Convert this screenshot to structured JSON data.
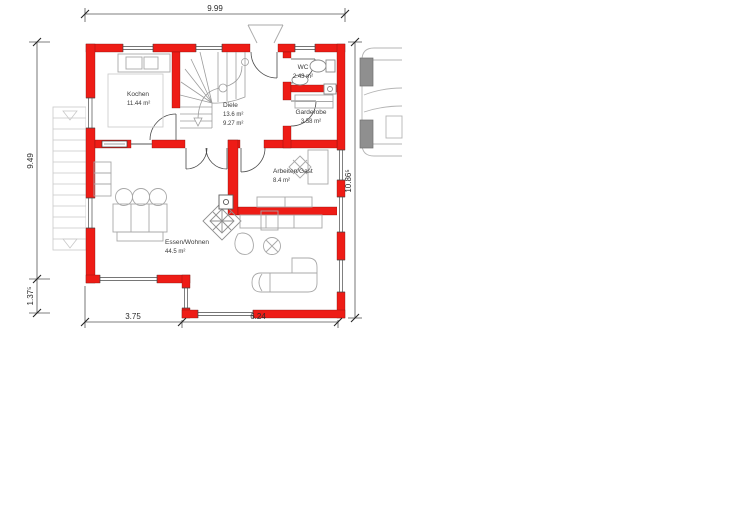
{
  "floorplan": {
    "rooms": {
      "kochen": {
        "name": "Kochen",
        "area": "11.44 m²"
      },
      "diele": {
        "name": "Diele",
        "area1": "13.6 m²",
        "area2": "9.27 m²"
      },
      "wc": {
        "name": "WC",
        "area": "2.43 m²"
      },
      "garderobe": {
        "name": "Garderobe",
        "area": "3.58 m²"
      },
      "essen_wohnen": {
        "name": "Essen/Wohnen",
        "area": "44.5 m²"
      },
      "arbeiten_gast": {
        "name": "Arbeiten/Gast",
        "area": "8.4 m²"
      }
    },
    "dimensions": {
      "top_width": "9.99",
      "left_upper": "9.49",
      "left_lower": "1.37⁵",
      "right_height": "10.86⁵",
      "bottom_left": "3.75",
      "bottom_right": "6.24"
    },
    "colors": {
      "wall": "#ee1c16",
      "furniture_line": "#a8a8a8",
      "dimension_text": "#2b2b2b"
    }
  }
}
